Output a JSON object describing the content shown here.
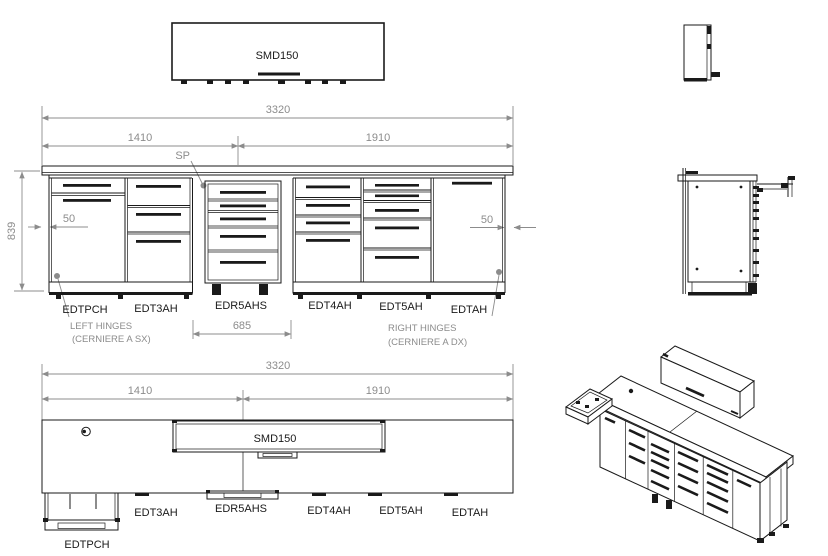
{
  "colors": {
    "line": "#1a1a1a",
    "dim_gray": "#8c8c8c",
    "background": "#ffffff"
  },
  "overhead_front": {
    "label": "SMD150"
  },
  "front": {
    "dim_total": "3320",
    "dim_left": "1410",
    "dim_right": "1910",
    "dim_height": "839",
    "dim_overhang_left": "50",
    "dim_overhang_right": "50",
    "dim_bay": "685",
    "sp": "SP",
    "units": [
      "EDTPCH",
      "EDT3AH",
      "EDR5AHS",
      "EDT4AH",
      "EDT5AH",
      "EDTAH"
    ],
    "left_hinges_line1": "LEFT HINGES",
    "left_hinges_line2": "(CERNIERE A SX)",
    "right_hinges_line1": "RIGHT HINGES",
    "right_hinges_line2": "(CERNIERE A DX)"
  },
  "plan": {
    "dim_total": "3320",
    "dim_left": "1410",
    "dim_right": "1910",
    "overhead_label": "SMD150",
    "units": [
      "EDTPCH",
      "EDT3AH",
      "EDR5AHS",
      "EDT4AH",
      "EDT5AH",
      "EDTAH"
    ]
  }
}
